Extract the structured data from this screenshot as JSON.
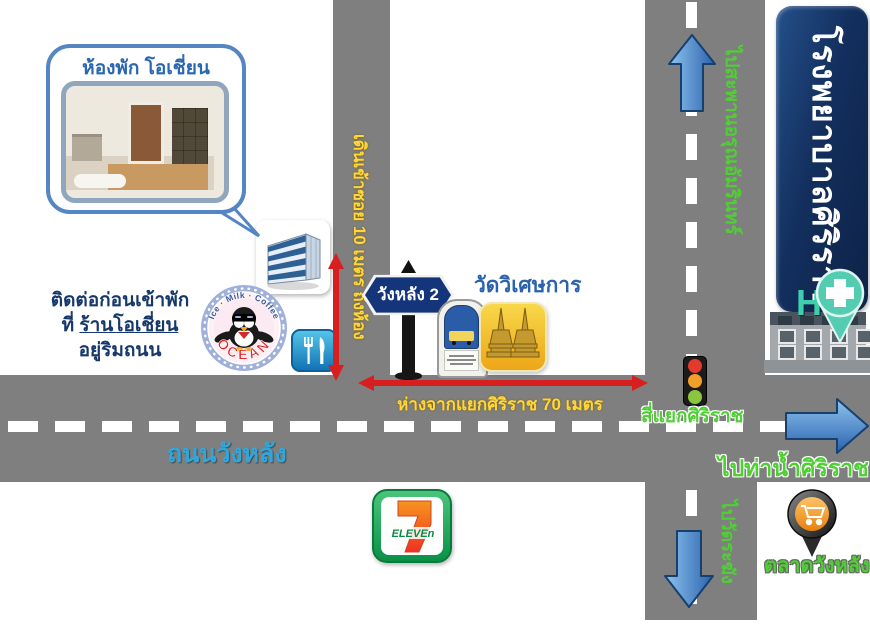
{
  "bubble": {
    "title": "ห้องพัก โอเชี่ยน"
  },
  "contact": {
    "line1": "ติดต่อก่อนเข้าพัก",
    "line2_prefix": "ที่ ",
    "shop_name": "ร้านโอเชี่ยน",
    "line3": "อยู่ริมถนน"
  },
  "ocean": {
    "arc_top": "Ice · Milk · Coffee",
    "arc_bottom": "OCEAN"
  },
  "sign": {
    "label": "วังหลัง 2"
  },
  "temple": {
    "label": "วัดวิเศษการ"
  },
  "labels": {
    "soi_walk": "เดินเข้าซอย 10 เมตร ถึงห้อง",
    "distance": "ห่างจากแยกศิริราช 70 เมตร",
    "intersection": "สี่แยกศิริราช",
    "road_name": "ถนนวังหลัง",
    "to_bridge": "ไปสะพานอรุณอัมรินทร์",
    "to_pier": "ไปท่าน้ำศิริราช",
    "to_wat_rakang": "ไปวัดระฆัง",
    "market": "ตลาดวังหลัง"
  },
  "hospital": {
    "banner": "โรงพยาบาลศิริราช",
    "h": "H"
  },
  "seven_eleven": {
    "seven": "7",
    "eleven": "ELEVEn"
  },
  "colors": {
    "road": "#7f7f7f",
    "green_label": "#50cf35",
    "yellow_label": "#ffd63c",
    "red_arrow": "#d81f1f",
    "banner_navy": "#0d2347",
    "teal": "#3ecfad",
    "road_name_blue": "#2fa7dc"
  }
}
